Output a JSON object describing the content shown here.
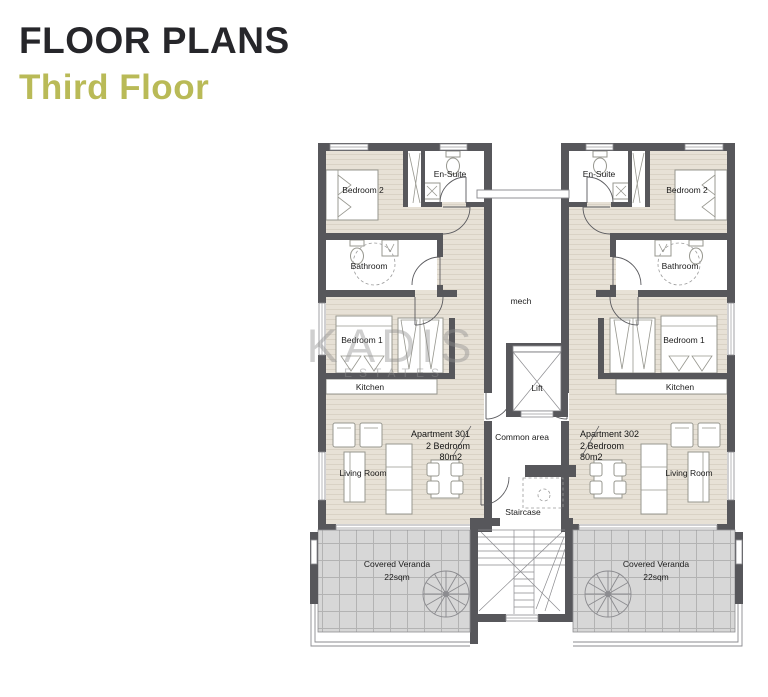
{
  "header": {
    "title": "FLOOR PLANS",
    "subtitle": "Third Floor"
  },
  "watermark": {
    "title": "KADIS",
    "subtitle": "ESTATES"
  },
  "apartment_301": {
    "name": "Apartment 301",
    "spec": "2 Bedroom",
    "area": "80m2",
    "rooms": {
      "bedroom_2": "Bedroom 2",
      "en_suite": "En-Suite",
      "bathroom": "Bathroom",
      "bedroom_1": "Bedroom 1",
      "kitchen": "Kitchen",
      "living_room": "Living Room"
    },
    "veranda_label": "Covered Veranda",
    "veranda_area": "22sqm"
  },
  "apartment_302": {
    "name": "Apartment 302",
    "spec": "2 Bedroom",
    "area": "80m2",
    "rooms": {
      "bedroom_2": "Bedroom 2",
      "en_suite": "En-Suite",
      "bathroom": "Bathroom",
      "bedroom_1": "Bedroom 1",
      "kitchen": "Kitchen",
      "living_room": "Living Room"
    },
    "veranda_label": "Covered Veranda",
    "veranda_area": "22sqm"
  },
  "core": {
    "mech": "mech",
    "lift": "Lift",
    "common_area": "Common area",
    "staircase": "Staircase"
  },
  "colors": {
    "accent": "#b9ba57",
    "title": "#26262a",
    "wall": "#57575b",
    "floor": "#e7e1d6",
    "floor_line": "#d9d2c5",
    "veranda": "#d7d7d7",
    "veranda_line": "#b3b3b3"
  }
}
